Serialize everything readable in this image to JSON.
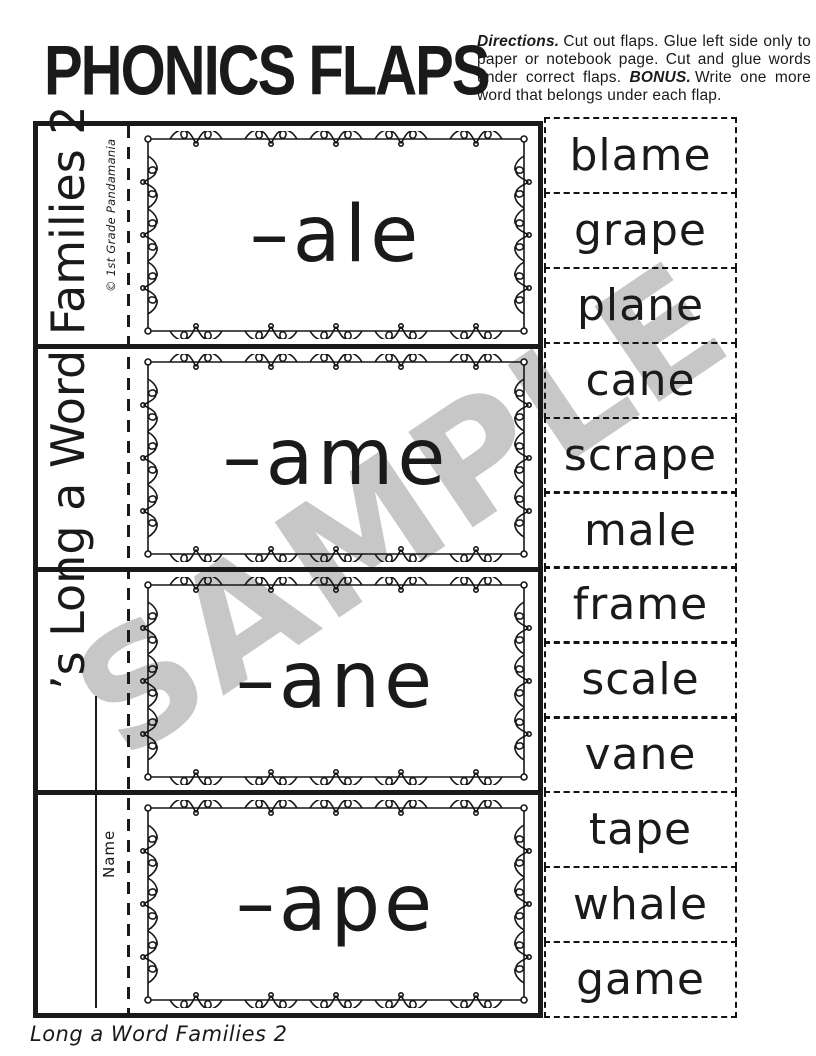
{
  "header": {
    "title": "PHONICS FLAPS"
  },
  "directions": {
    "label": "Directions.",
    "body": "Cut out flaps. Glue left side only to paper or notebook page. Cut and glue words under correct flaps.",
    "bonus_label": "BONUS.",
    "bonus_body": "Write one more word that belongs under each flap."
  },
  "spine": {
    "title": "’s Long a Word Families 2",
    "name_label": "Name",
    "credit": "© 1st Grade Pandamania"
  },
  "flaps": [
    {
      "label": "–ale"
    },
    {
      "label": "–ame"
    },
    {
      "label": "–ane"
    },
    {
      "label": "–ape"
    }
  ],
  "words": [
    "blame",
    "grape",
    "plane",
    "cane",
    "scrape",
    "male",
    "frame",
    "scale",
    "vane",
    "tape",
    "whale",
    "game"
  ],
  "watermark": "SAMPLE",
  "footer": "Long a Word Families 2",
  "colors": {
    "ink": "#1a1a1a",
    "watermark": "#c7c7c7"
  }
}
